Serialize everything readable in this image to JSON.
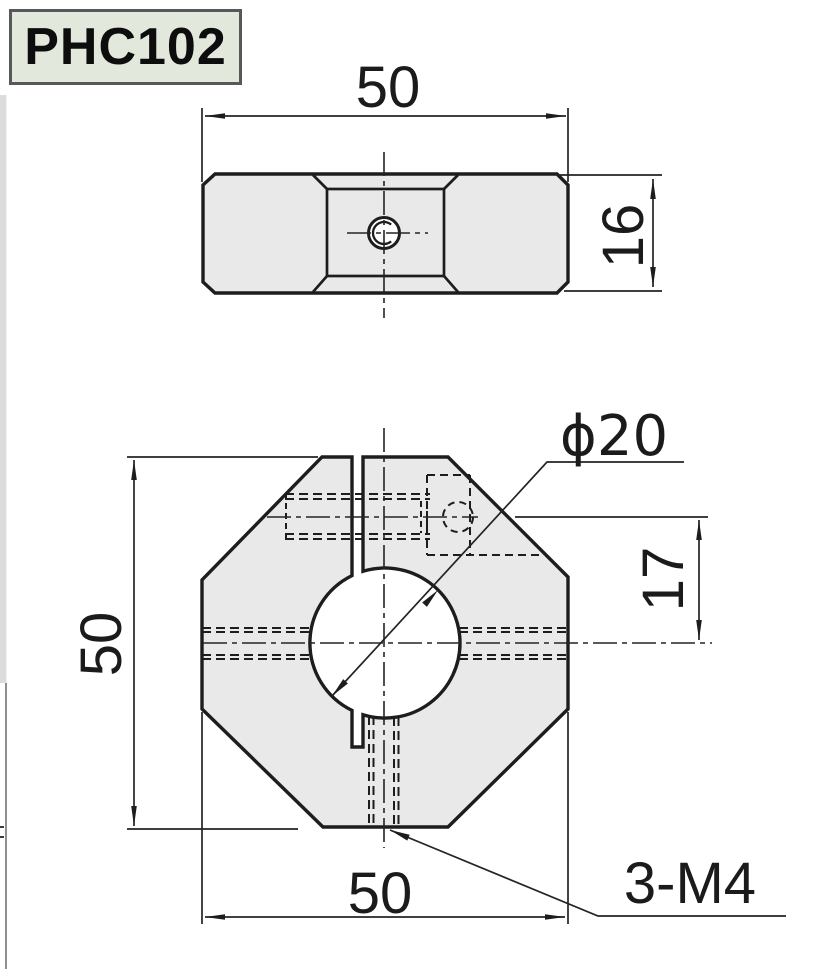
{
  "title": {
    "part_number": "PHC102"
  },
  "top_view": {
    "width_dim": "50",
    "thickness_dim": "16"
  },
  "front_view": {
    "height_dim": "50",
    "width_dim": "50",
    "bore_diameter": "ϕ20",
    "bore_offset_dim": "17",
    "thread_callout": "3-M4"
  },
  "colors": {
    "part_fill": "#e9e9e9",
    "line": "#1d1d1d",
    "title_bg": "#e3e8dd",
    "title_border": "#57585a"
  }
}
